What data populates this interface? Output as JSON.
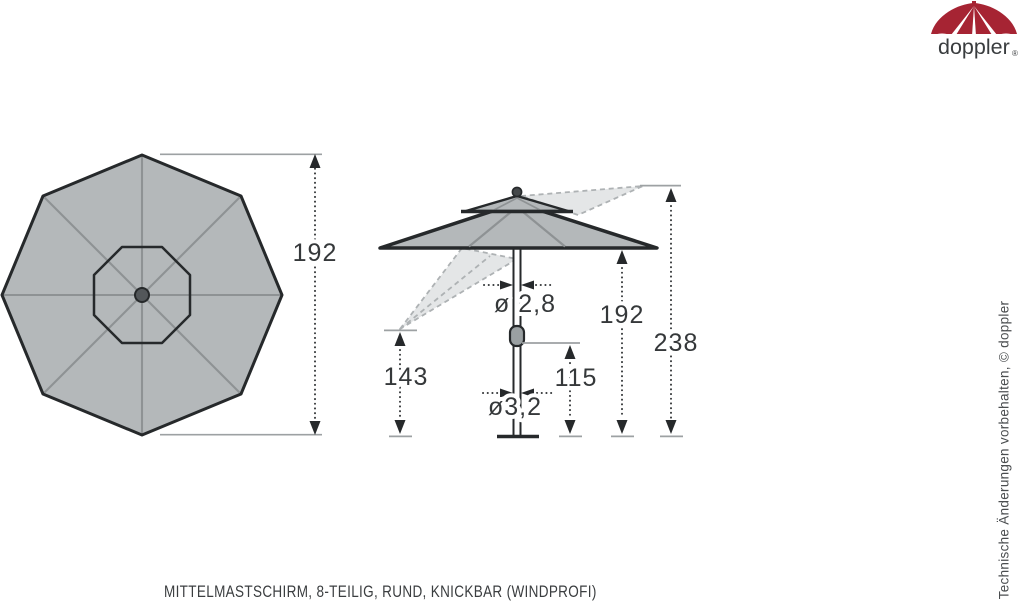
{
  "logo": {
    "brand": "doppler",
    "registered_mark": "®"
  },
  "drawing": {
    "caption": "MITTELMASTSCHIRM, 8-TEILIG, RUND, KNICKBAR (WINDPROFI)",
    "side_note": "Technische Änderungen vorbehalten, © doppler",
    "dimensions": {
      "top_view_diameter": "192",
      "pole_upper_diameter": "ø 2,8",
      "pole_lower_diameter": "ø3,2",
      "canopy_edge_height": "192",
      "total_height": "238",
      "tilted_edge_height": "143",
      "crank_height": "115"
    }
  },
  "colors": {
    "brand_red": "#a62433",
    "canopy_gray": "#b4b8ba",
    "outline_dark": "#26292b",
    "rib_gray": "#8e9294",
    "ghost_gray": "#e4e6e7",
    "dimension_text": "#35383a"
  }
}
